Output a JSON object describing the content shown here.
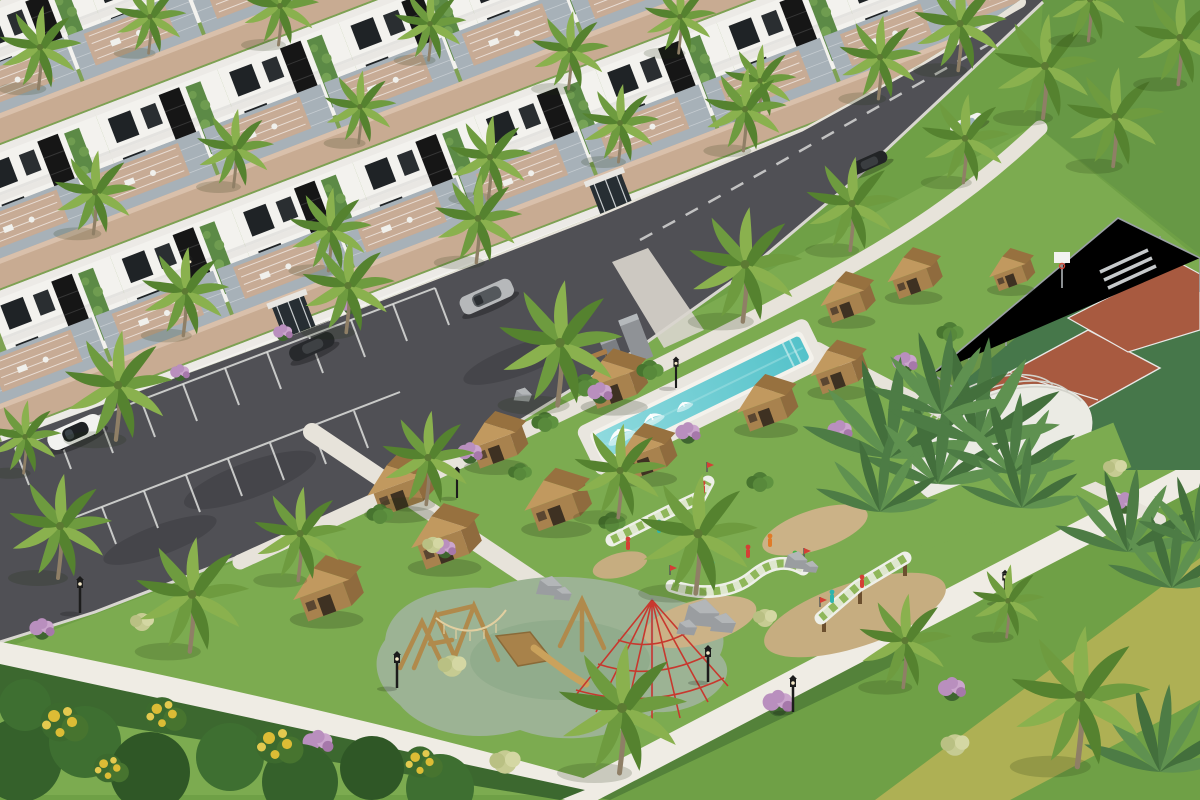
{
  "scene": {
    "title": "Aerial 3D architectural rendering of a tropical resort residential community",
    "description": "High-angle daytime render: rows of modern white condo buildings with beige rooftop pergolas upper-left, a diagonal asphalt street with parking bays and five cars, and a central landscaped park with a long turquoise lap pool, wooden kiosk cabins, mini-golf courses, a wooden playground with a red rope pyramid, a fenced clay sports court, a white shade dome, white walking paths, lawns, hedges and many palm trees.",
    "setting": "sunny daytime",
    "view": "isometric-style aerial perspective"
  },
  "palette": {
    "grass_base": "#6fa046",
    "grass_lawn": "#679845",
    "grass_park": "#7cab50",
    "turf_olive": "#aeb054",
    "hedge": "#3c682f",
    "road": "#505055",
    "path": "#e7e3da",
    "path_bright": "#efece4",
    "white_line": "#dedfdd",
    "bldg_wall": "#f3f2ee",
    "bldg_roof": "#c8ab92",
    "bldg_roof_top": "#d9c0ab",
    "bldg_deck": "#a7b1b8",
    "glass_dark": "#1f2326",
    "lattice_dark": "#161616",
    "plant_wall": "#5c8a46",
    "pool_water_1": "#8fdade",
    "pool_water_2": "#54c2ca",
    "pool_deck": "#e9e6df",
    "cabin_wall": "#a8824e",
    "cabin_wall_shade": "#8f6b3e",
    "cabin_roof": "#c1995f",
    "cabin_roof_shade": "#97713f",
    "cabin_door": "#3e3122",
    "court_clay": "#a85a40",
    "court_pad": "#46774a",
    "fence_gray": "#9aa0a4",
    "sand": "#c6ad80",
    "rubber_surface": "#9cb394",
    "rock_gray": "#9a9da0",
    "rock_light": "#b3b6b8",
    "palm_green_1": "#6e9b3f",
    "palm_green_2": "#8ab14e",
    "palm_green_3": "#55822f",
    "trunk": "#8f7f66",
    "banana_1": "#4d7c45",
    "banana_2": "#5f9150",
    "banana_3": "#436f3c",
    "purple_bloom": "#b98fbe",
    "purple_bloom_2": "#cba5cd",
    "yellow_bloom": "#dcbc35",
    "lamp_black": "#1c1c1c",
    "car_white": "#f2f2f0",
    "car_silver": "#b6b8ba",
    "car_black": "#222426",
    "wood_play": "#b08a4c",
    "rope_red": "#c8382e",
    "dome_white": "#ececе5",
    "tuft": "#c6cb92"
  },
  "objects": {
    "buildings": {
      "label": "Modern white condo buildings with beige rooftop pergolas, dark glass, black lattice panels and green plant walls",
      "rows": 4
    },
    "street": {
      "label": "Asphalt street with white lane markings"
    },
    "parking": {
      "label": "Parking lot with empty white-marked stalls"
    },
    "sidewalk": {
      "label": "Concrete sidewalk along the buildings"
    },
    "cars": [
      {
        "label": "white sports car",
        "color": "white",
        "location": "parking lot"
      },
      {
        "label": "dark sedan parked at curb",
        "color": "black",
        "location": "curbside near building"
      },
      {
        "label": "silver SUV",
        "color": "silver",
        "location": "street"
      },
      {
        "label": "white sedan",
        "color": "white",
        "location": "upper street"
      },
      {
        "label": "black sedan",
        "color": "black",
        "location": "upper street"
      }
    ],
    "pool": {
      "label": "Long turquoise lap pool with white fountains and stone monoliths"
    },
    "cabins": {
      "label": "Wooden kiosk cabins with gabled roofs",
      "count": 12
    },
    "mini_golf": {
      "label": "Elevated mini-golf courses with green-and-white checkered turf",
      "count": 3,
      "figure_colors": [
        "red",
        "teal",
        "green",
        "orange"
      ]
    },
    "playground": {
      "label": "Wooden climbing playground with rope bridge, slide and red rope pyramid on sage rubber surface"
    },
    "sports_court": {
      "label": "Fenced clay sports court with basketball hoop and bleachers"
    },
    "dome": {
      "label": "White ribbed shade dome"
    },
    "paths": {
      "label": "White concrete walking paths through the park"
    },
    "palms": {
      "label": "Coconut palm trees",
      "count": 34
    },
    "banana_plants": {
      "label": "Banana and traveler plants"
    },
    "bushes": {
      "label": "Green shrubs with purple and yellow blooms"
    },
    "lamps": {
      "label": "Black park lanterns",
      "count": 8
    },
    "rocks": {
      "label": "Decorative gray boulders"
    },
    "sand": {
      "label": "Sand mounds and dry patches"
    },
    "hedge": {
      "label": "Trimmed dark hedge along foreground path"
    },
    "turf": {
      "label": "Olive turf strip, lower right"
    },
    "benches": {
      "label": "Park benches",
      "count": 2
    }
  }
}
